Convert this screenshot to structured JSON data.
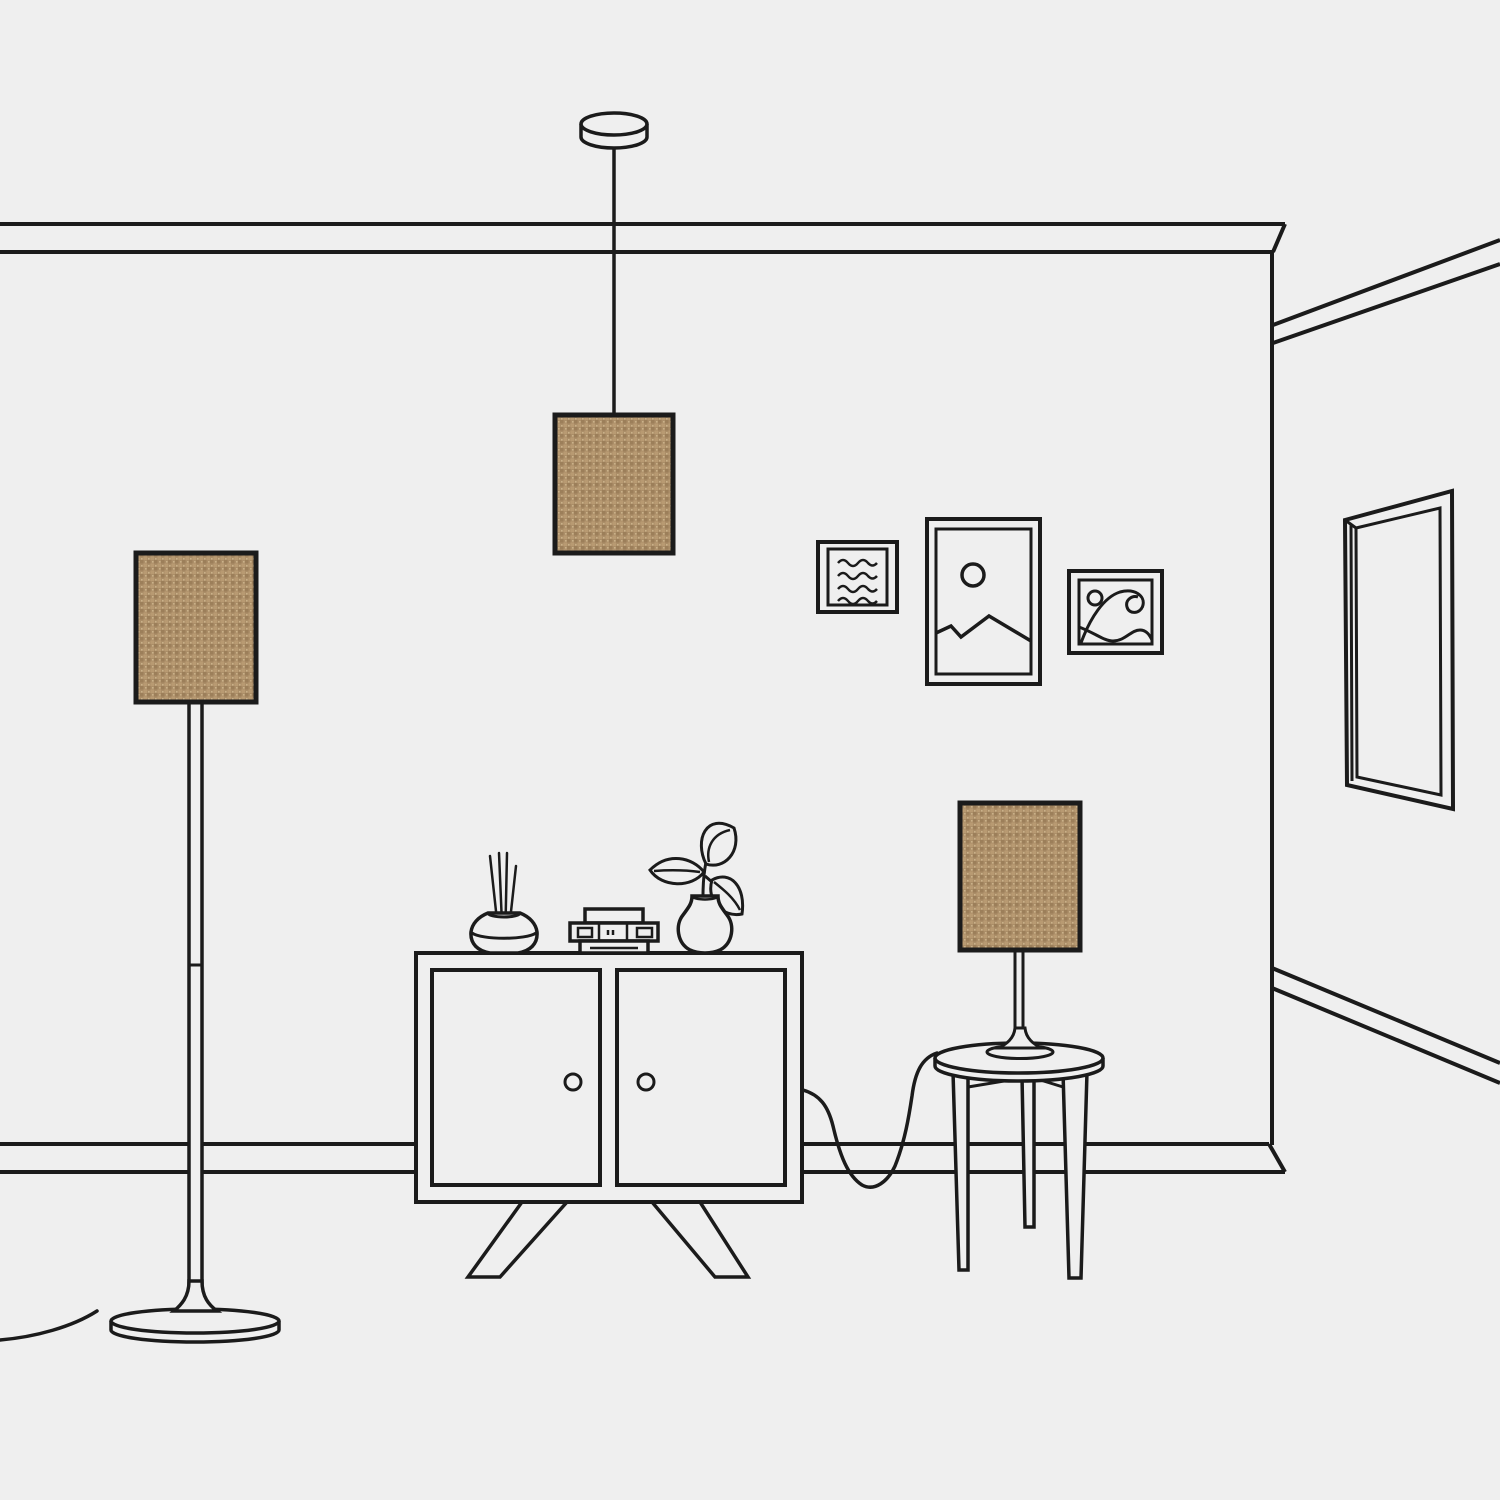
{
  "scene": {
    "title": "Minimal line-art illustration of a living room corner with three matching tan fabric lamps",
    "wall_decor": [
      {
        "name": "frame-waves",
        "motif": "four wavy horizontal lines"
      },
      {
        "name": "frame-mountain",
        "motif": "sun circle over mountain peaks"
      },
      {
        "name": "frame-wave-art",
        "motif": "small sun and curling ocean wave"
      },
      {
        "name": "mirror",
        "motif": "tall rectangular mirror in perspective on side wall"
      }
    ],
    "objects": [
      {
        "name": "pendant-lamp",
        "parts": [
          "ceiling canopy disc",
          "drop cord",
          "rectangular woven shade"
        ]
      },
      {
        "name": "floor-lamp",
        "parts": [
          "rectangular woven shade",
          "two-segment pole",
          "trumpet foot",
          "round disc base",
          "power cord to wall"
        ]
      },
      {
        "name": "table-lamp",
        "parts": [
          "rectangular woven shade",
          "thin stem",
          "trumpet foot",
          "round platter",
          "power cord draped to floor"
        ]
      },
      {
        "name": "cabinet",
        "parts": [
          "two doors with round knobs",
          "splayed angled legs"
        ],
        "top_items": [
          "reed diffuser with sticks",
          "small radio of stacked boxes",
          "vase with three-leaf plant"
        ]
      },
      {
        "name": "side-table",
        "parts": [
          "round top",
          "three tapered legs",
          "v-shaped apron"
        ]
      }
    ],
    "room": {
      "front_wall": "crown molding at top, baseboard at bottom, ends in a mitered edge at right",
      "side_wall": "recedes to the right with slanted molding and baseboard"
    }
  },
  "theme": {
    "background": "#efefef",
    "line": "#1b1b1b",
    "shade_base": "#ab8e68",
    "shade_dark": "#9c7f5a",
    "shade_mid": "#b89a72",
    "shade_light": "#cab189"
  }
}
